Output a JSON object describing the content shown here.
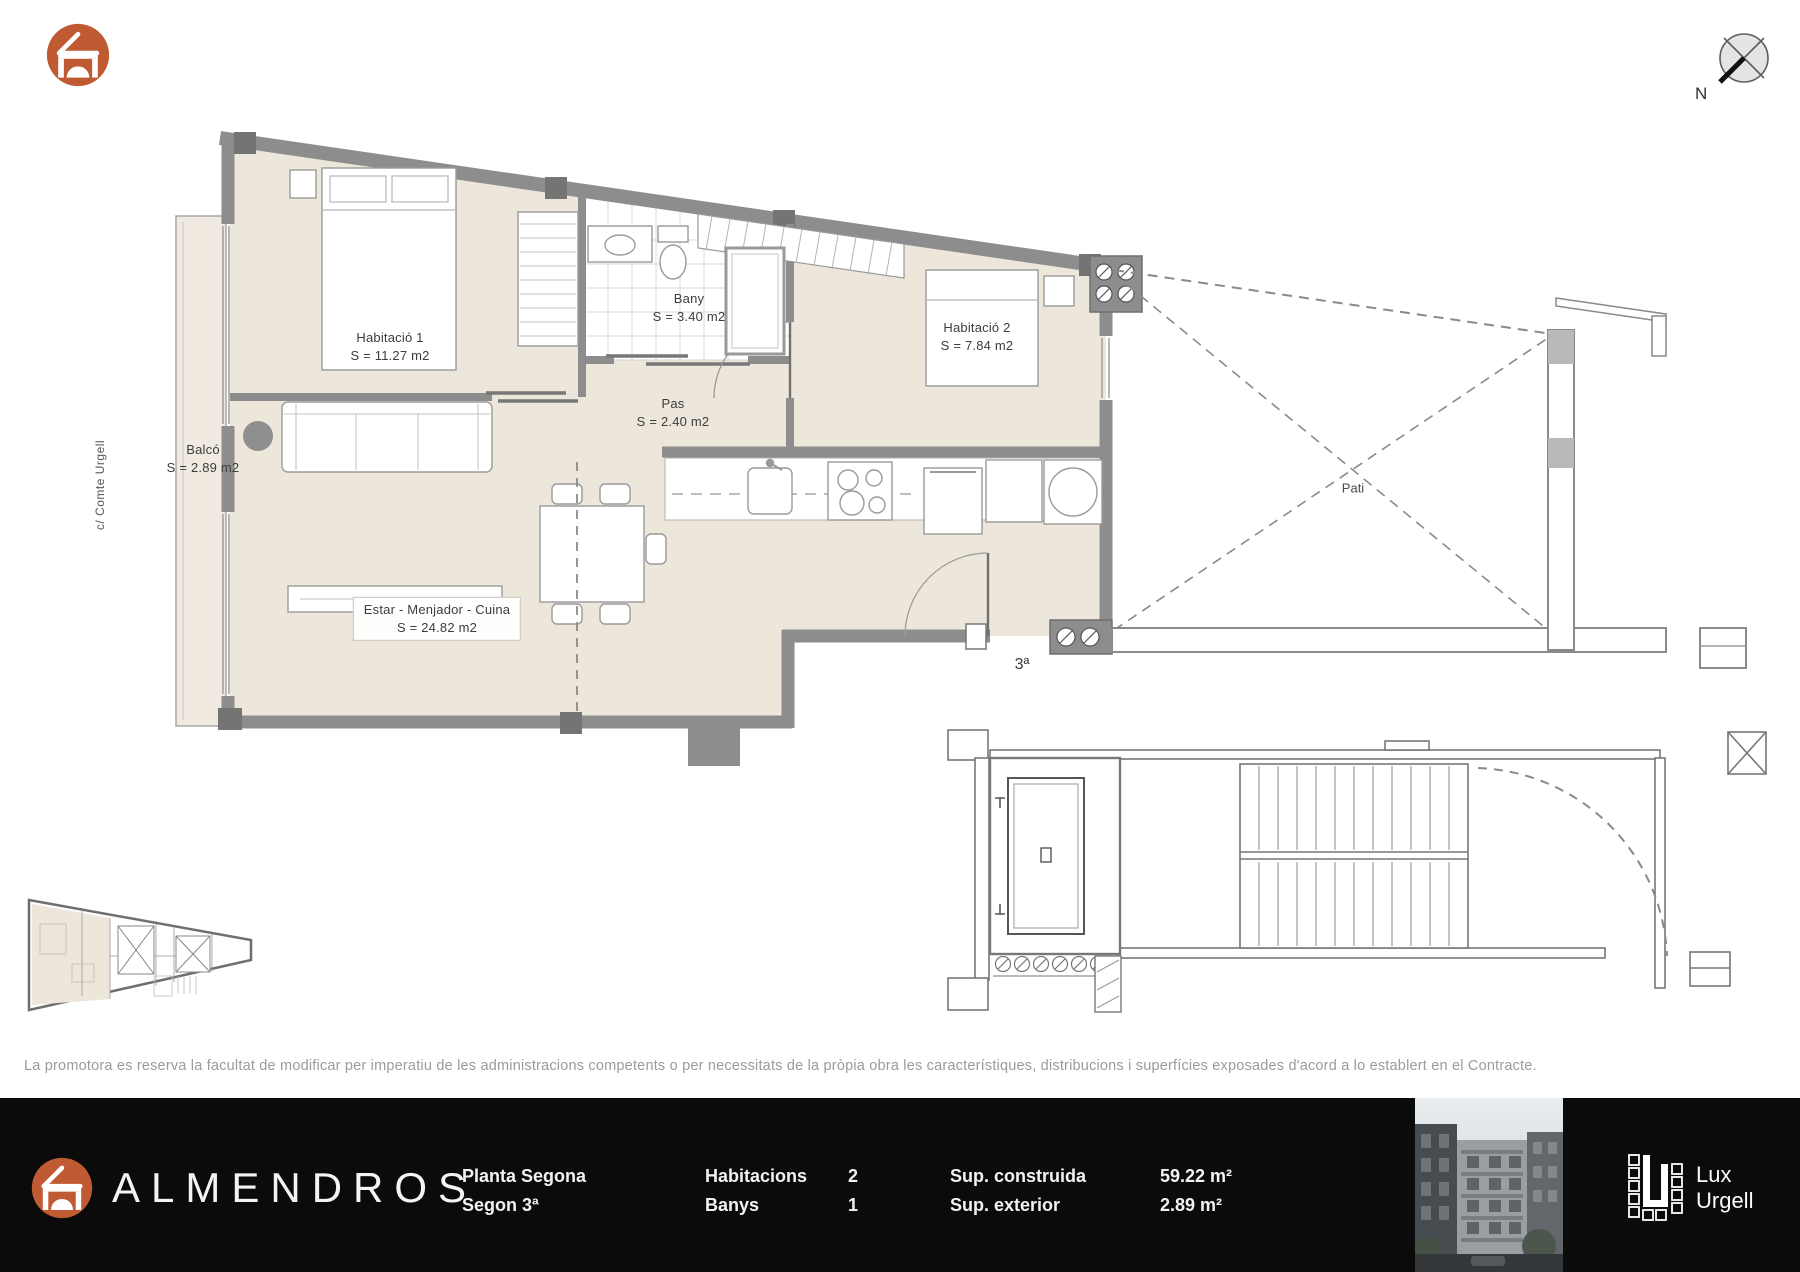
{
  "brand": {
    "name": "ALMENDROS",
    "partner": {
      "line1": "Lux",
      "line2": "Urgell"
    }
  },
  "compass": {
    "label": "N"
  },
  "street_label": "c/ Comte Urgell",
  "plan": {
    "rooms": [
      {
        "name": "Habitació 1",
        "area": "S = 11.27 m2"
      },
      {
        "name": "Bany",
        "area": "S = 3.40 m2"
      },
      {
        "name": "Habitació 2",
        "area": "S = 7.84 m2"
      },
      {
        "name": "Pas",
        "area": "S = 2.40 m2"
      },
      {
        "name": "Estar - Menjador - Cuina",
        "area": "S = 24.82 m2"
      },
      {
        "name": "Balcó",
        "area": "S = 2.89 m2"
      }
    ],
    "pati_label": "Pati",
    "unit_label": "3ª"
  },
  "disclaimer": "La promotora es reserva la facultat de modificar per imperatiu de les administracions competents o per necessitats de la pròpia obra les característiques, distribucions i superfícies exposades d'acord a lo establert en el Contracte.",
  "footer": {
    "floor_title": "Planta Segona",
    "unit_title": "Segon 3ª",
    "stats": [
      {
        "label": "Habitacions",
        "value": "2"
      },
      {
        "label": "Banys",
        "value": "1"
      },
      {
        "label": "Sup. construida",
        "value": "59.22 m²"
      },
      {
        "label": "Sup. exterior",
        "value": "2.89 m²"
      }
    ]
  },
  "colors": {
    "accent": "#C05A33",
    "wall_gray": "#8d8d8d",
    "floor_beige": "#EDE7DB",
    "footer_bg": "#0b0b0b",
    "disclaimer_gray": "#9b9b9b"
  }
}
